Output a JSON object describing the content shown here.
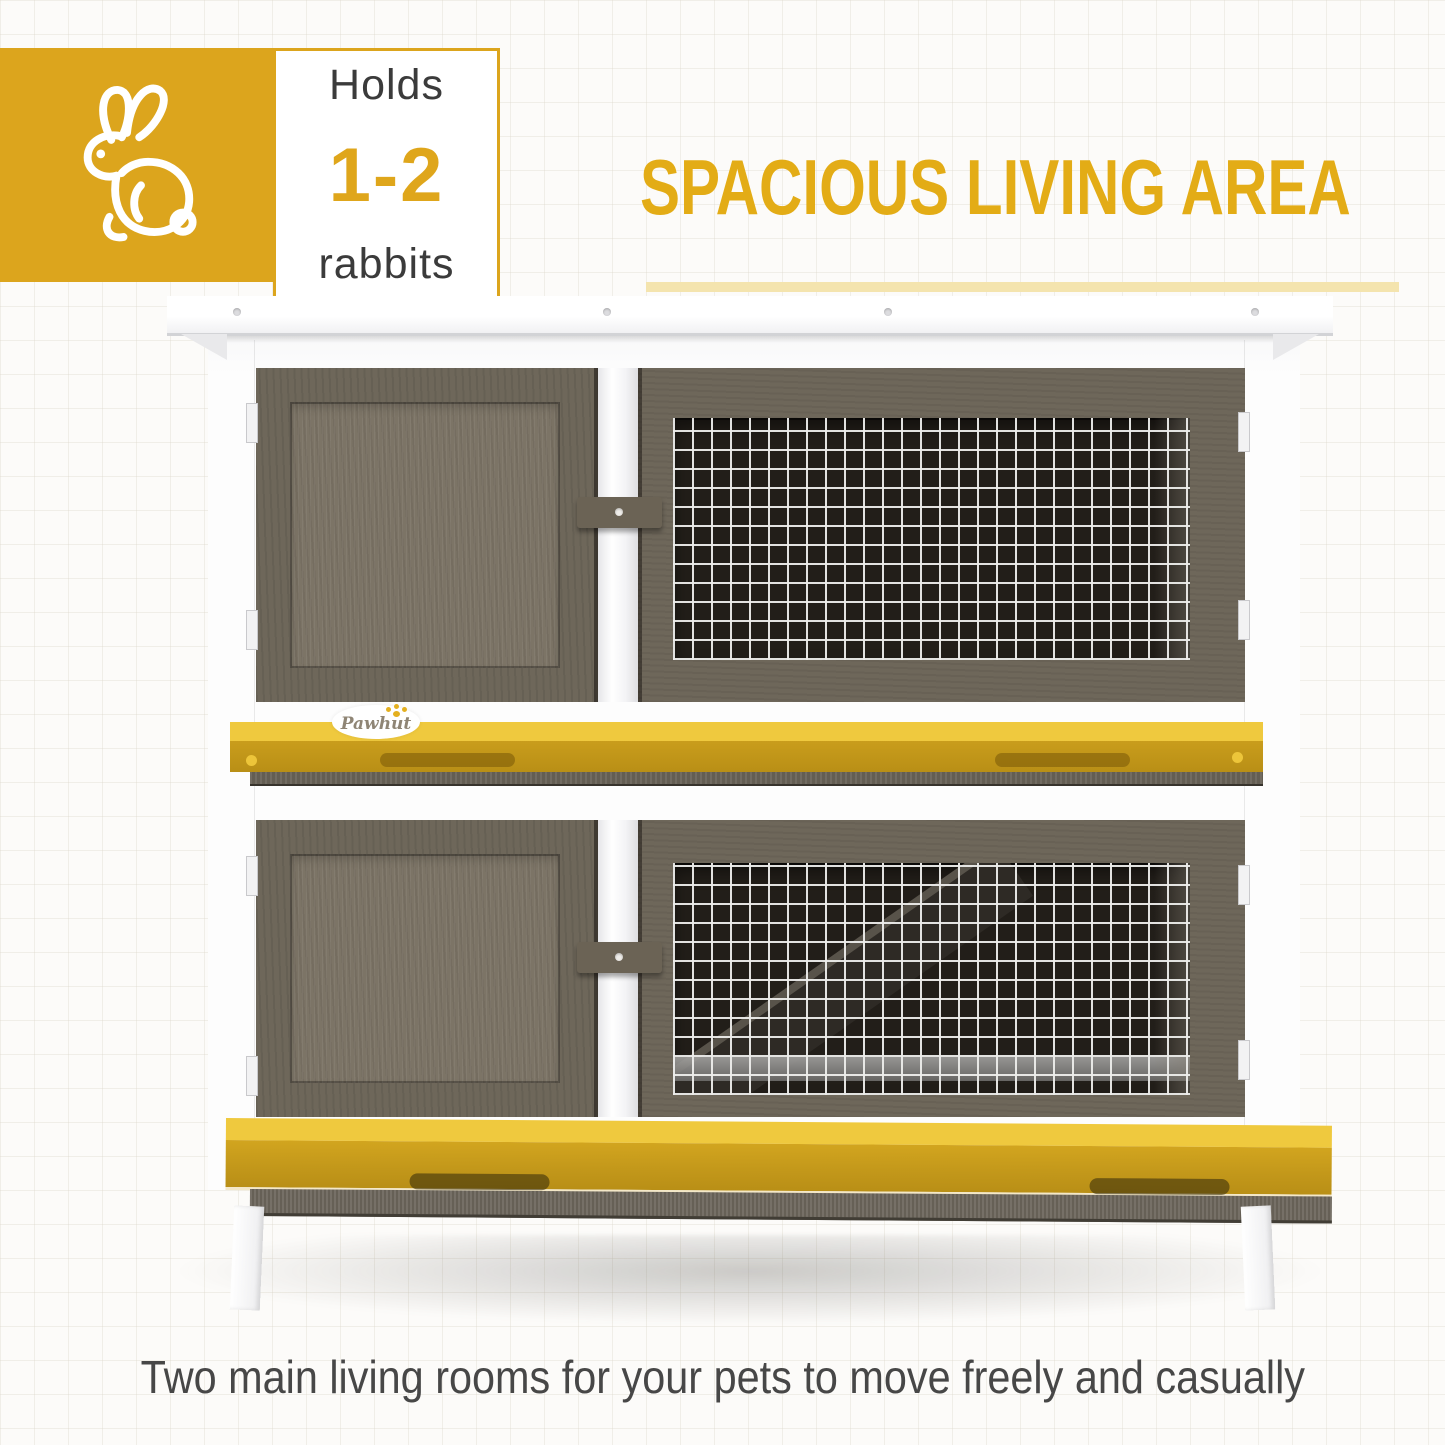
{
  "badge": {
    "holds": "Holds",
    "count": "1-2",
    "animal": "rabbits"
  },
  "heading": {
    "title": "SPACIOUS LIVING AREA"
  },
  "caption": "Two main living rooms for your pets to move freely and casually",
  "hutch": {
    "brand": "Pawhut"
  },
  "icons": {
    "rabbit": "rabbit-icon",
    "paw": "paw-print-icon"
  },
  "colors": {
    "accent_yellow": "#DCA51D",
    "heading_yellow": "#E3AC16",
    "underline_yellow": "#F4E4AE",
    "count_yellow": "#DFA61B",
    "tray_top": "#EFC93E",
    "tray_front": "#C99D1C",
    "tray_deep": "#B98F16",
    "wood_frame": "#6E675A",
    "wood_panel": "#7C7466",
    "wood_dark_band": "#645E53",
    "mesh_bg": "#221E19",
    "mesh_wire": "#EDEDEB",
    "text_dark": "#3B3B3B",
    "caption_gray": "#474747",
    "bg": "#FCFBF9",
    "grid_line": "#E7E2D8"
  }
}
